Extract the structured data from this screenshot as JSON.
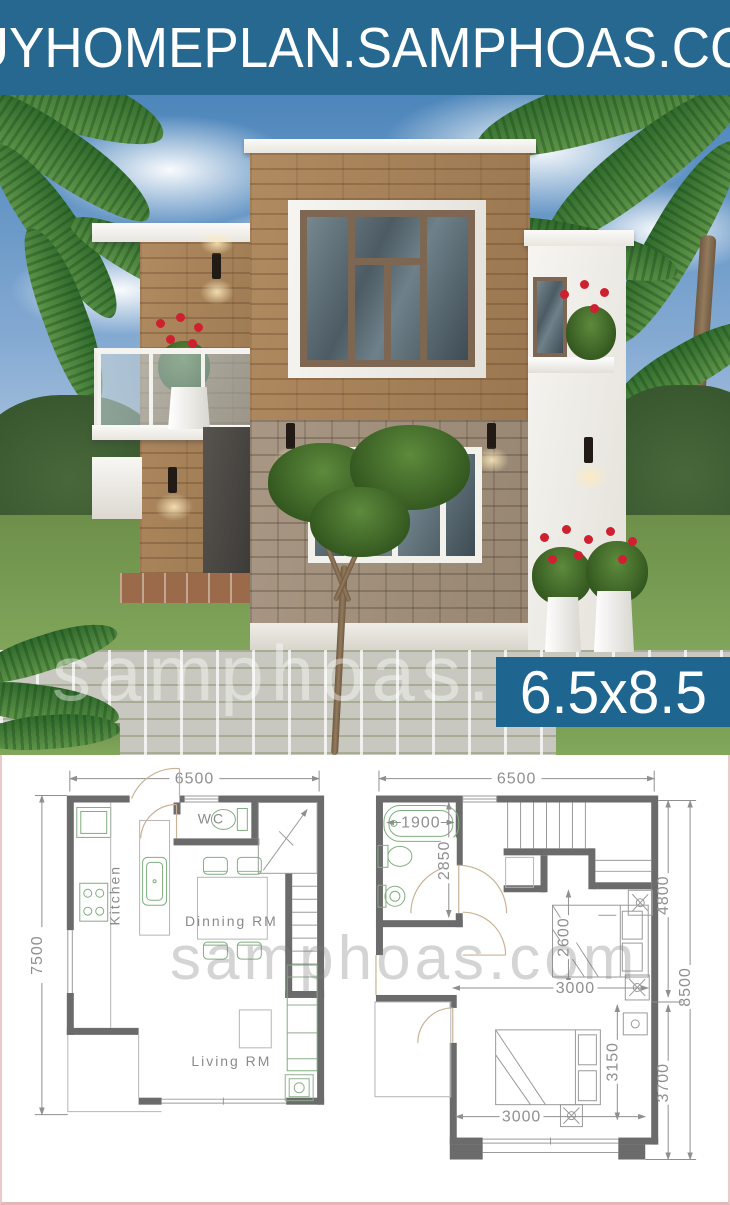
{
  "header": {
    "title": "BUYHOMEPLAN.SAMPHOAS.COM",
    "bg": "#26688F"
  },
  "hero": {
    "watermark": "samphoas.com",
    "badge": {
      "label": "6.5x8.5",
      "bg": "#1E6590"
    }
  },
  "plans": {
    "watermark": "samphoas.com",
    "ground": {
      "dim_width": "6500",
      "dim_depth": "7500",
      "label_wc": "WC",
      "label_kitchen": "Kitchen",
      "label_dining": "Dinning RM",
      "label_living": "Living RM"
    },
    "upper": {
      "dim_width": "6500",
      "dim_tub": "1900",
      "dim_bath_depth": "2850",
      "dim_bed1_width": "2600",
      "dim_bed1_len": "3000",
      "dim_right_upper": "4800",
      "dim_right_total": "8500",
      "dim_bed2_depth": "3150",
      "dim_bed2_width": "3000",
      "dim_right_lower": "3700"
    },
    "colors": {
      "wall": "#6b6b6b",
      "fixture": "#7fae7f",
      "dimension": "#8f8f8f",
      "frame": "#eccaca"
    }
  }
}
